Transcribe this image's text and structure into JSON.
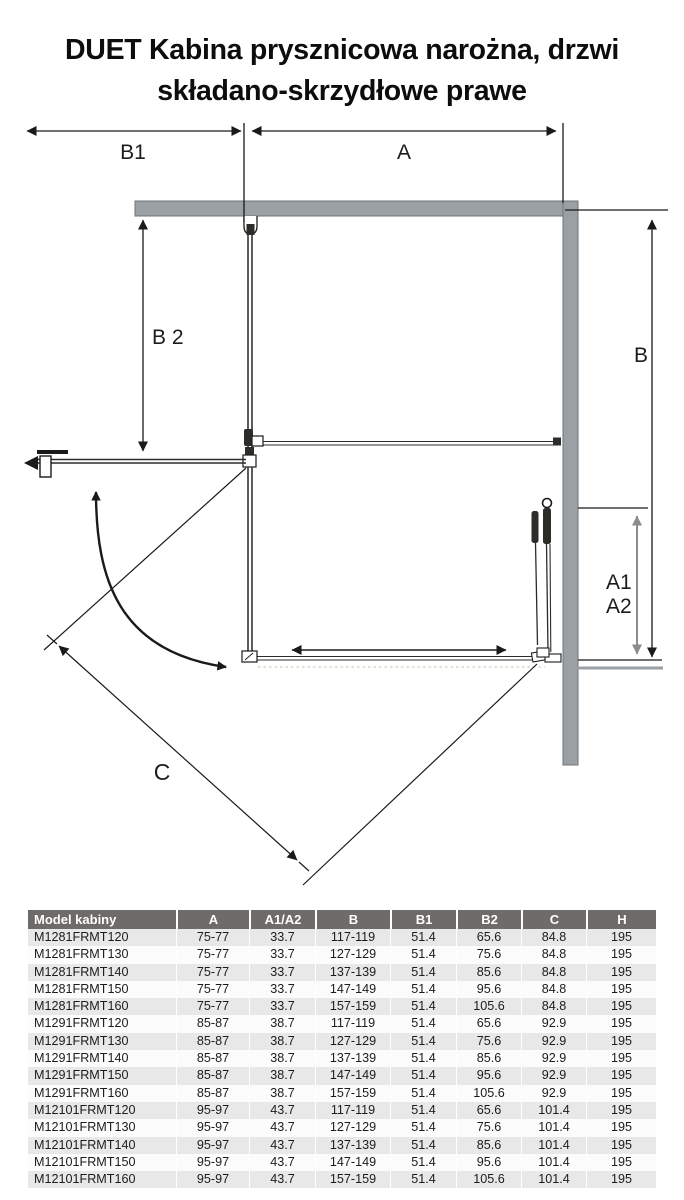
{
  "title": {
    "line1": "DUET Kabina prysznicowa narożna, drzwi",
    "line2": "składano-skrzydłowe prawe"
  },
  "diagram": {
    "labels": {
      "b1": "B1",
      "a": "A",
      "b2": "B 2",
      "b": "B",
      "a1": "A1",
      "a2": "A2",
      "c": "C"
    },
    "colors": {
      "wall_gray": "#9ba0a4",
      "line_black": "#1a1a1a",
      "gray_arrow": "#8c8c8c"
    }
  },
  "table": {
    "columns": [
      "Model kabiny",
      "A",
      "A1/A2",
      "B",
      "B1",
      "B2",
      "C",
      "H"
    ],
    "rows": [
      [
        "M1281FRMT120",
        "75-77",
        "33.7",
        "117-119",
        "51.4",
        "65.6",
        "84.8",
        "195"
      ],
      [
        "M1281FRMT130",
        "75-77",
        "33.7",
        "127-129",
        "51.4",
        "75.6",
        "84.8",
        "195"
      ],
      [
        "M1281FRMT140",
        "75-77",
        "33.7",
        "137-139",
        "51.4",
        "85.6",
        "84.8",
        "195"
      ],
      [
        "M1281FRMT150",
        "75-77",
        "33.7",
        "147-149",
        "51.4",
        "95.6",
        "84.8",
        "195"
      ],
      [
        "M1281FRMT160",
        "75-77",
        "33.7",
        "157-159",
        "51.4",
        "105.6",
        "84.8",
        "195"
      ],
      [
        "M1291FRMT120",
        "85-87",
        "38.7",
        "117-119",
        "51.4",
        "65.6",
        "92.9",
        "195"
      ],
      [
        "M1291FRMT130",
        "85-87",
        "38.7",
        "127-129",
        "51.4",
        "75.6",
        "92.9",
        "195"
      ],
      [
        "M1291FRMT140",
        "85-87",
        "38.7",
        "137-139",
        "51.4",
        "85.6",
        "92.9",
        "195"
      ],
      [
        "M1291FRMT150",
        "85-87",
        "38.7",
        "147-149",
        "51.4",
        "95.6",
        "92.9",
        "195"
      ],
      [
        "M1291FRMT160",
        "85-87",
        "38.7",
        "157-159",
        "51.4",
        "105.6",
        "92.9",
        "195"
      ],
      [
        "M12101FRMT120",
        "95-97",
        "43.7",
        "117-119",
        "51.4",
        "65.6",
        "101.4",
        "195"
      ],
      [
        "M12101FRMT130",
        "95-97",
        "43.7",
        "127-129",
        "51.4",
        "75.6",
        "101.4",
        "195"
      ],
      [
        "M12101FRMT140",
        "95-97",
        "43.7",
        "137-139",
        "51.4",
        "85.6",
        "101.4",
        "195"
      ],
      [
        "M12101FRMT150",
        "95-97",
        "43.7",
        "147-149",
        "51.4",
        "95.6",
        "101.4",
        "195"
      ],
      [
        "M12101FRMT160",
        "95-97",
        "43.7",
        "157-159",
        "51.4",
        "105.6",
        "101.4",
        "195"
      ]
    ]
  }
}
